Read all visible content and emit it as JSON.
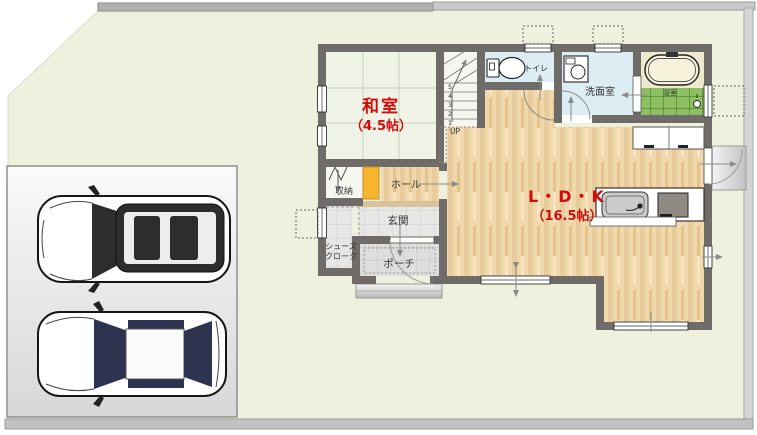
{
  "palette": {
    "lot_green": "#eef1dd",
    "wall_gray": "#6e6b68",
    "wood_floor": "#efd6a8",
    "tatami": "#f0f4e6",
    "wet_room_blue": "#dceef4",
    "bath_tile_green": "#8cc063",
    "accent_red": "#d30b0b",
    "door_orange": "#f5b52e"
  },
  "rooms": {
    "washitsu": {
      "label": "和室",
      "size": "（4.5帖）"
    },
    "ldk": {
      "label": "L・D・K",
      "size": "（16.5帖）"
    },
    "senmenshitsu": {
      "label": "洗面室"
    },
    "toilet": {
      "label": "トイレ"
    },
    "bath": {
      "label": "浴室"
    },
    "storage": {
      "label": "収納"
    },
    "hall": {
      "label": "ホール"
    },
    "genkan": {
      "label": "玄関"
    },
    "shoes_cloak": {
      "label_line1": "シューズ",
      "label_line2": "クローク"
    },
    "porch": {
      "label": "ポーチ"
    }
  },
  "stairs": {
    "up": "UP",
    "numbers": [
      "1",
      "2",
      "3",
      "4",
      "5"
    ]
  }
}
